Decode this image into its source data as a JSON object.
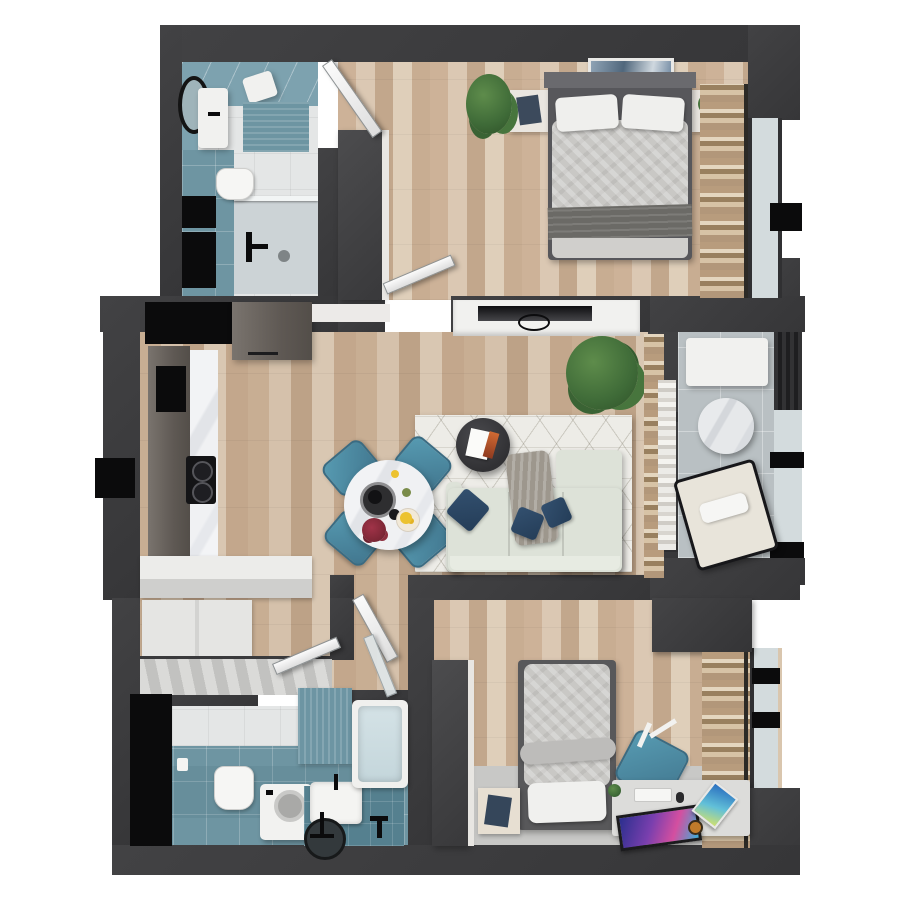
{
  "meta": {
    "description": "3D top-down rendered floor plan of a two-bedroom apartment",
    "canvas": {
      "width": 900,
      "height": 900
    },
    "background": "#ffffff",
    "visible_text": []
  },
  "palette": {
    "wall": "#3a3a3c",
    "wall_dark": "#2f2f31",
    "appliance_black": "#0b0b0c",
    "wood_floor": "#cdb59d",
    "wood_floor_light": "#d2bba4",
    "bathroom_tile_teal": "#6e95a2",
    "bathroom_wall_teal": "#7da2af",
    "tile_white": "#e4e6e6",
    "balcony_tile": "#b9c0c3",
    "marble": "#f0f1f3",
    "rug_living": "#edece7",
    "rug_bedroom2": "#c8c8c6",
    "sofa": "#dde2d8",
    "cushion_navy": "#2c4663",
    "chair_teal": "#4f8ba1",
    "kitchen_cabinet": "#6e6862",
    "bedding_gray": "#c9c8c5",
    "blanket_dark": "#6b6a66",
    "pillow_white": "#efefed",
    "curtain_tan": "#b89c7d",
    "curtain_sheer": "#ecebe7",
    "plant_green": "#3f6b38",
    "door_white": "#f1f1f1",
    "window_glass": "#d3dbdd",
    "monitor_screen_accent": "#7a3fae",
    "flower_red": "#8e2f3e",
    "fruit_yellow": "#ecc22f"
  },
  "rooms": {
    "bathroom_top": {
      "name": "bathroom-top-left",
      "items": [
        "mirror",
        "vanity-sink",
        "towel",
        "bath-mat",
        "toilet",
        "shower",
        "storage-cabinets",
        "door"
      ]
    },
    "bedroom_main": {
      "name": "bedroom-top-right",
      "items": [
        "double-bed",
        "pillows",
        "duvet",
        "throw-blanket",
        "art-frame",
        "nightstand-left",
        "nightstand-right",
        "wardrobe",
        "clothes-rack",
        "plant",
        "window",
        "door"
      ]
    },
    "living_kitchen": {
      "name": "living-dining-kitchen",
      "items": [
        "kitchen-cabinets",
        "oven",
        "cooktop",
        "countertop",
        "dining-table",
        "dining-chairs",
        "flowers",
        "fruit-bowl",
        "rug",
        "coffee-table",
        "sofa",
        "cushions",
        "throw-blanket",
        "tv",
        "tv-console",
        "plant",
        "curtains"
      ]
    },
    "balcony": {
      "name": "balcony",
      "items": [
        "bench",
        "side-table",
        "lounge-chair",
        "glass-railing",
        "glass-door"
      ]
    },
    "hallway": {
      "name": "entry-hallway",
      "items": [
        "wardrobe",
        "sliding-closet",
        "tall-cabinet",
        "doors"
      ]
    },
    "bathroom_bottom": {
      "name": "bathroom-bottom",
      "items": [
        "toilet",
        "washing-machine",
        "sink-counter",
        "round-basin",
        "bathtub",
        "towel",
        "glass-door"
      ]
    },
    "bedroom_second": {
      "name": "bedroom-bottom-right",
      "items": [
        "single-bed",
        "pillow",
        "duvet",
        "nightstand",
        "desk",
        "monitor",
        "keyboard",
        "tablet",
        "desk-chair",
        "wardrobe-left",
        "wardrobe-corner",
        "clothes-rack",
        "rug",
        "window"
      ]
    }
  }
}
